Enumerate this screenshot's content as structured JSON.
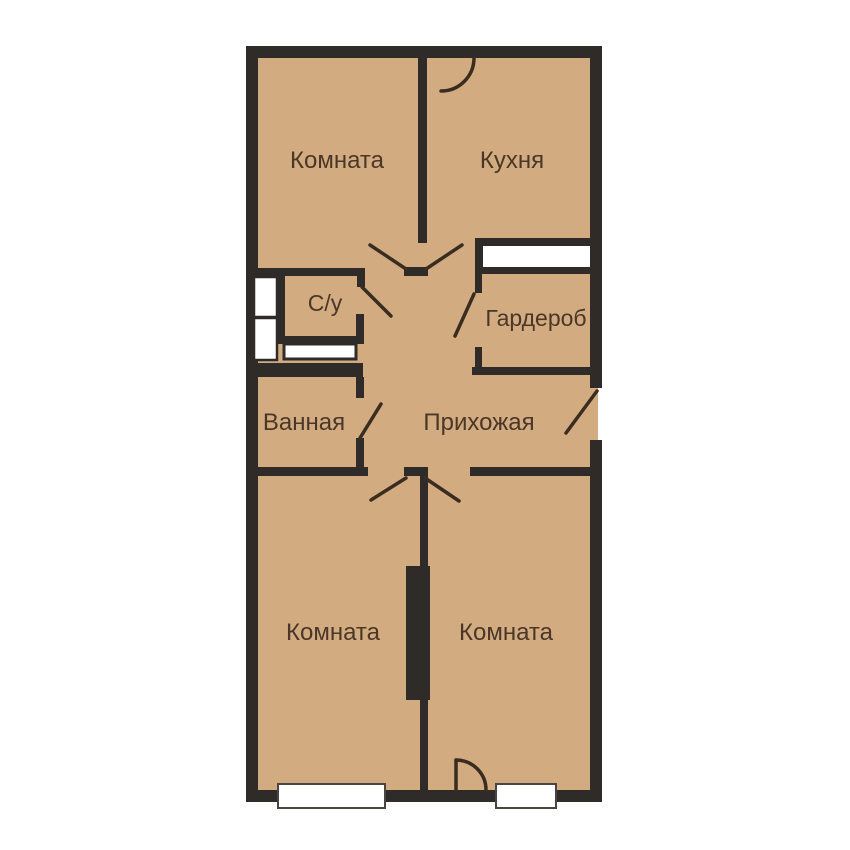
{
  "title": "Apartment floor plan",
  "colors": {
    "background": "#ffffff",
    "floor": "#d2ac80",
    "wall": "#2e2b28",
    "line": "#3a2d20",
    "label": "#4a3728",
    "fixture": "#ffffff",
    "window_stroke": "#4a4540"
  },
  "rooms": [
    {
      "name": "room-top-left",
      "label": "Комната"
    },
    {
      "name": "kitchen",
      "label": "Кухня"
    },
    {
      "name": "toilet",
      "label": "С/у"
    },
    {
      "name": "wardrobe",
      "label": "Гардероб"
    },
    {
      "name": "bathroom",
      "label": "Ванная"
    },
    {
      "name": "hallway",
      "label": "Прихожая"
    },
    {
      "name": "room-bottom-left",
      "label": "Комната"
    },
    {
      "name": "room-bottom-right",
      "label": "Комната"
    }
  ]
}
